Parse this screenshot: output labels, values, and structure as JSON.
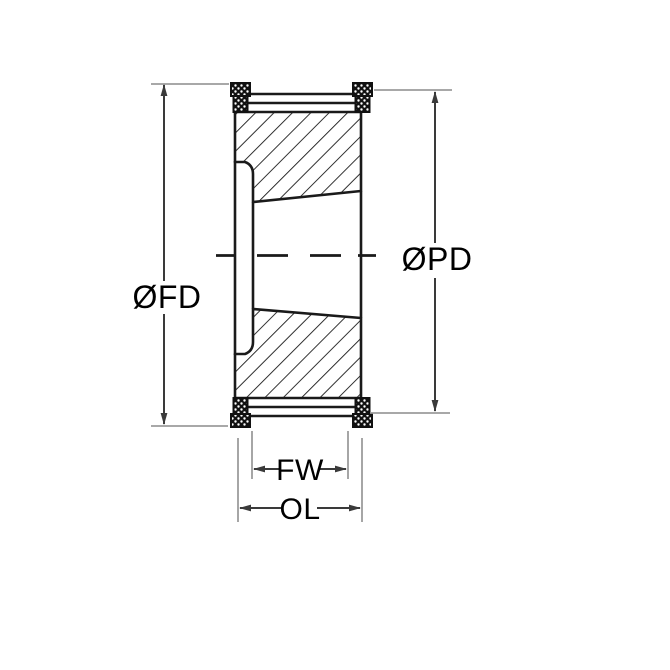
{
  "drawing": {
    "labels": {
      "flange_diameter": "ØFD",
      "pitch_diameter": "ØPD",
      "face_width": "FW",
      "overall_length": "OL"
    },
    "colors": {
      "outline": "#1a1a1a",
      "extension_line": "#9c9c9c",
      "dimension_line": "#3a3a3a",
      "text": "#000000",
      "background": "#ffffff"
    }
  }
}
